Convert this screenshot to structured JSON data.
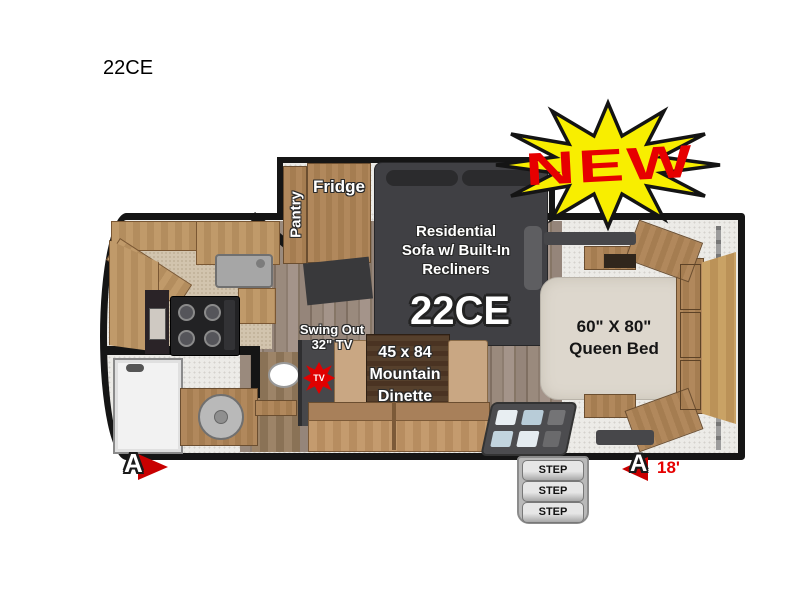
{
  "page": {
    "title": "22CE"
  },
  "floorplan": {
    "model": "22CE",
    "new_badge": "NEW",
    "marker_letter": "A",
    "length": "18'",
    "pantry": "Pantry",
    "fridge": "Fridge",
    "sofa": [
      "Residential",
      "Sofa w/ Built-In",
      "Recliners"
    ],
    "tv": [
      "Swing Out",
      "32\" TV"
    ],
    "tv_badge": "TV",
    "dinette": [
      "45 x 84",
      "Mountain",
      "Dinette"
    ],
    "bed": [
      "60\" X 80\"",
      "Queen Bed"
    ],
    "steps": [
      "STEP",
      "STEP",
      "STEP"
    ],
    "colors": {
      "burst_yellow": "#f8ee00",
      "badge_red": "#e60000",
      "marker_red": "#c80000",
      "wall_black": "#151515",
      "sofa_gray": "#404044",
      "cabinet_wood": "#ab7f52",
      "mattress": "#ddd7cd"
    }
  }
}
